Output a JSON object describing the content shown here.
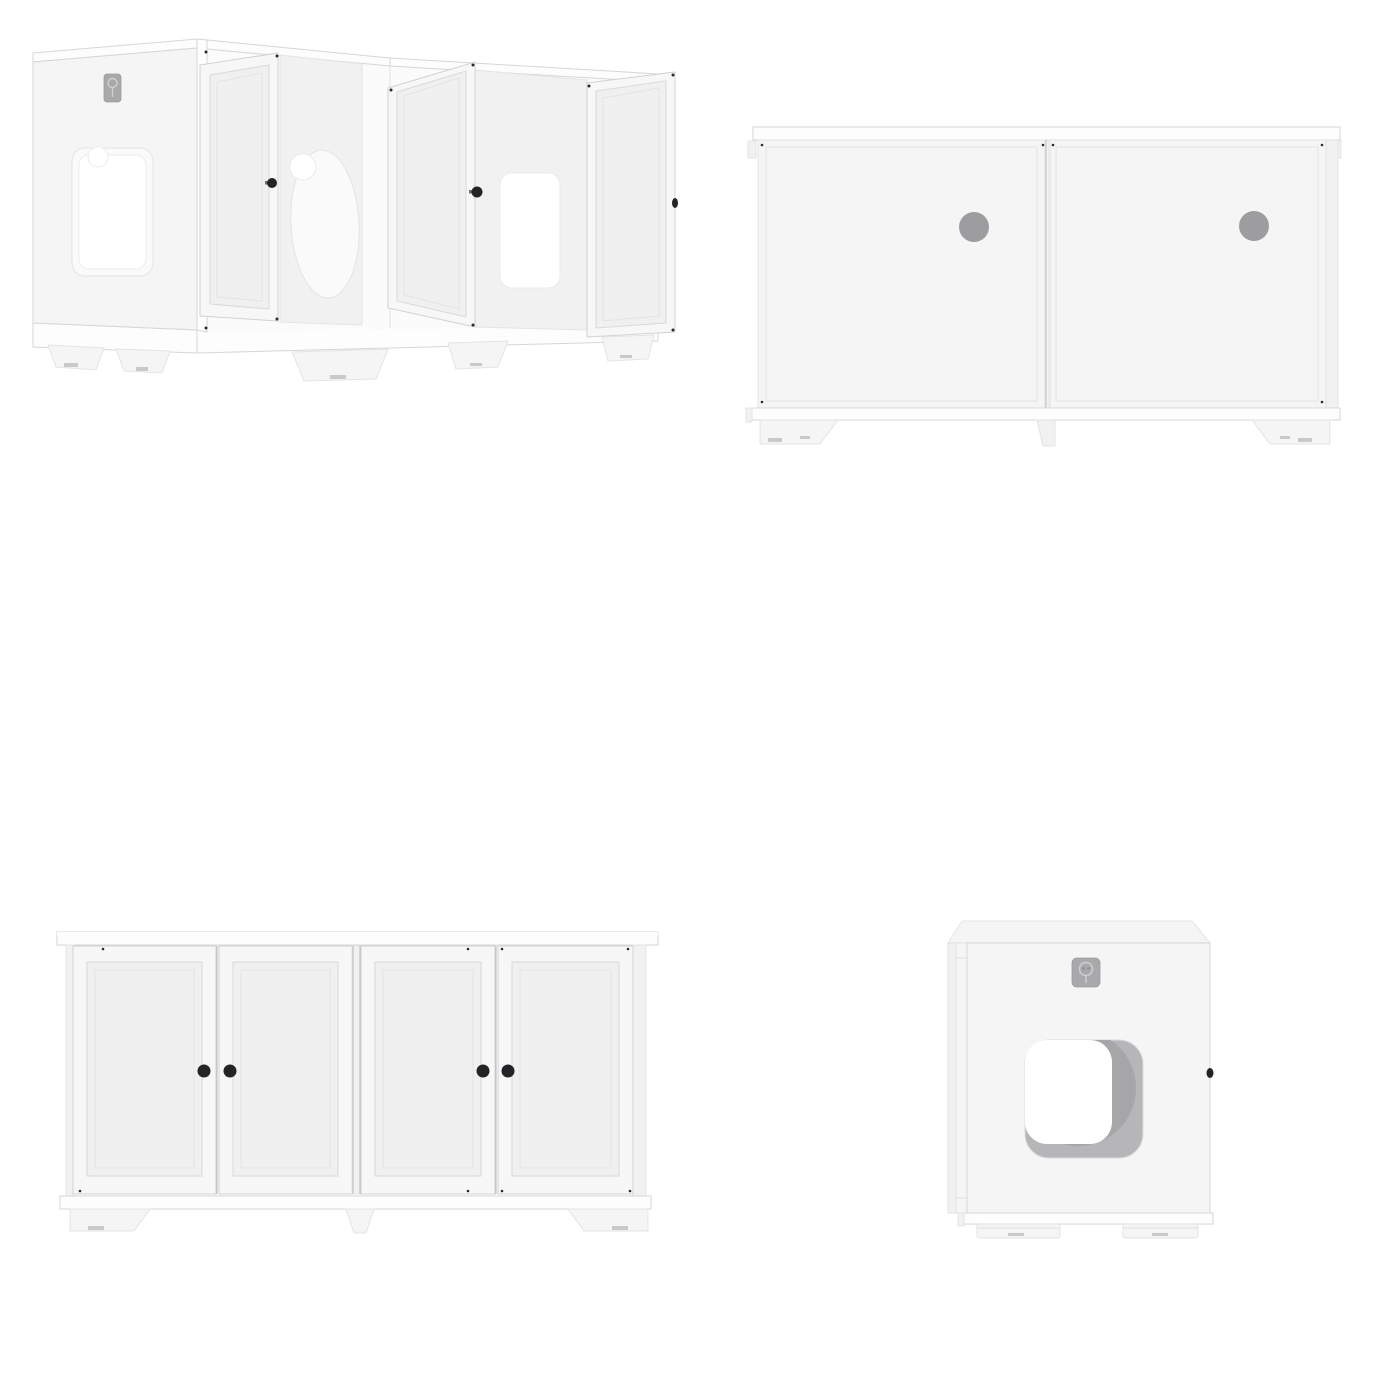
{
  "page": {
    "background": "#ffffff"
  },
  "colors": {
    "bg": "#ffffff",
    "white": "#fdfdfe",
    "panel": "#f5f5f6",
    "panel2": "#f1f1f2",
    "recess": "#fafafb",
    "edge": "#d6d6d8",
    "edgeSoft": "#e4e4e6",
    "hole": "#9d9da0",
    "scoop": "#a6a6a8",
    "scoopLight": "#b6b6b8",
    "badge": "#a9a9ab",
    "badgeGlyph": "#d0d0d2",
    "knob": "#242427",
    "pad": "#c9c9cb"
  },
  "views": [
    {
      "id": "open-perspective",
      "position": "top-left",
      "open_doors": 3,
      "visible_knobs": 3,
      "cutouts": [
        "side-window-with-notch",
        "oval-partition-pass-through",
        "square-back-pass-through"
      ],
      "brand_badges": 1
    },
    {
      "id": "back",
      "position": "top-right",
      "panels": 2,
      "vent_holes": 2
    },
    {
      "id": "front-closed",
      "position": "bottom-left",
      "doors": 4,
      "knobs": 4
    },
    {
      "id": "side-entry",
      "position": "bottom-right",
      "entry_cutouts": 1,
      "brand_badges": 1,
      "visible_knobs": 1
    }
  ],
  "icons": {
    "brand_badge": "brand-badge-icon",
    "door_knob": "door-knob",
    "vent_hole": "vent-hole",
    "entry_cutout": "cat-entry-cutout"
  }
}
